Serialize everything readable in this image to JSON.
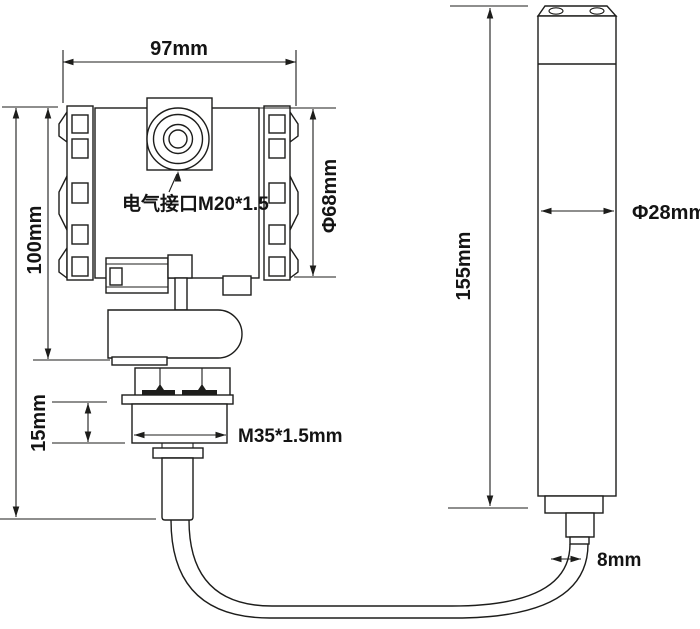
{
  "drawing": {
    "colors": {
      "line": "#1d1d1b",
      "background": "#ffffff",
      "text": "#141414"
    },
    "labels": {
      "top_width": "97mm",
      "housing_height": "100mm",
      "housing_diameter": "Φ68mm",
      "electrical_interface": "电气接口M20*1.5",
      "nut_height": "15mm",
      "thread_spec": "M35*1.5mm",
      "probe_length": "155mm",
      "probe_diameter": "Φ28mm",
      "cable_diameter": "8mm"
    }
  }
}
